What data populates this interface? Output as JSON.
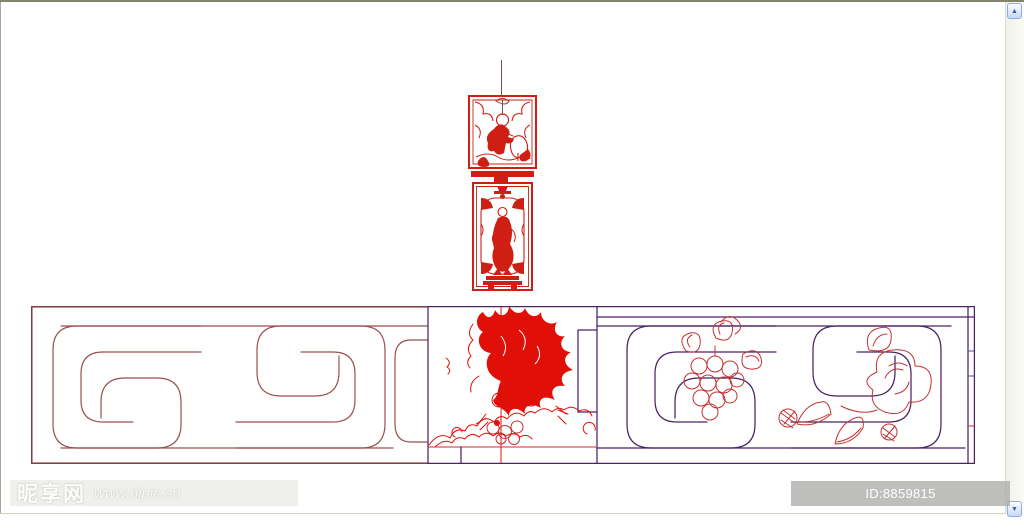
{
  "window": {
    "background": "#ffffff",
    "frame_border": "#82826f"
  },
  "drawing": {
    "colors": {
      "maroon": "#9b4f4f",
      "purple": "#4b2263",
      "red": "#e01008",
      "panel_red": "#cf1f14",
      "thin_red": "#c53131",
      "blue": "#3a55a8",
      "hang_line": "#7a5050"
    }
  },
  "scrollbar": {
    "up_glyph": "▲",
    "down_glyph": "▼"
  },
  "watermark": {
    "site_name": "昵享网",
    "site_url": "www.nipic.cn",
    "id_label": "ID:8859815 NO:20120729160335062391"
  }
}
